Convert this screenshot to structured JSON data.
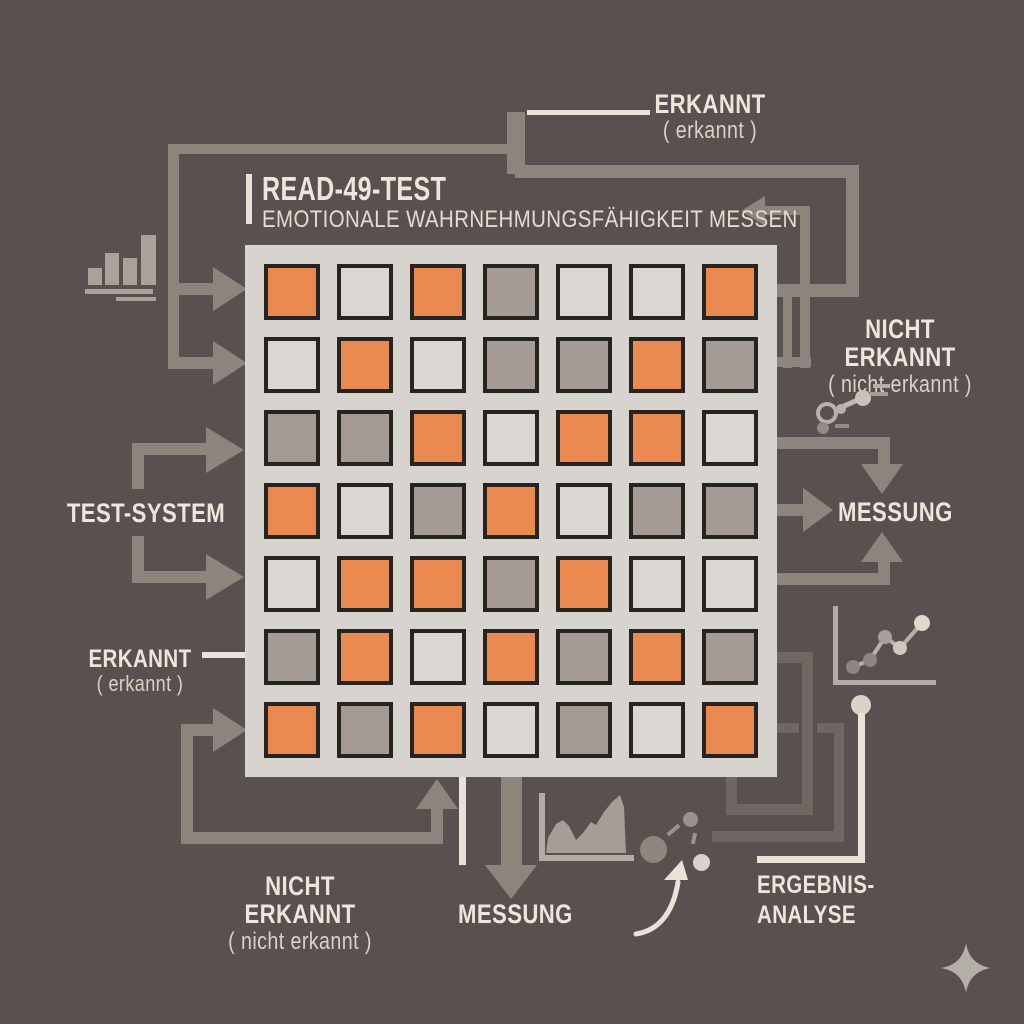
{
  "title": {
    "heading": "READ-49-TEST",
    "subtitle": "EMOTIONALE WAHRNEHMUNGSFÄHIGKEIT MESSEN"
  },
  "labels": {
    "top_erkannt": {
      "main": "ERKANNT",
      "sub": "( erkannt )"
    },
    "right_nicht_erkannt": {
      "main": "NICHT ERKANNT",
      "sub": "( nicht erkannt )"
    },
    "test_system": "TEST-SYSTEM",
    "right_messung": "MESSUNG",
    "left_erkannt": {
      "main": "ERKANNT",
      "sub": "( erkannt )"
    },
    "bottom_nicht_erkannt": {
      "main": "NICHT ERKANNT",
      "sub": "( nicht erkannt )"
    },
    "bottom_messung": "MESSUNG",
    "ergebnis_analyse": {
      "line1": "ERGEBNIS-",
      "line2": "ANALYSE"
    }
  },
  "grid": {
    "rows": 7,
    "cols": 7,
    "legend": {
      "O": "orange",
      "L": "light",
      "G": "gray"
    },
    "cells": [
      "OLOGLLO",
      "LOLGGOG",
      "GGOLOOL",
      "OLGOLGG",
      "LOOGOLL",
      "GOLOGOG",
      "OGOLGLO"
    ]
  },
  "colors": {
    "background": "#585150",
    "orange": "#ea8950",
    "cell_light": "#dad6d2",
    "cell_gray": "#a49b95",
    "grid_frame": "#d7d3ce",
    "cell_border": "#272320",
    "connector": "#8d847d",
    "connector_dark": "#6f6762",
    "cream": "#e9e3d7",
    "text": "#ece6dc",
    "text_dim": "#d9d2c5",
    "icon_light": "#b3aca5",
    "icon_mid": "#938b84"
  },
  "icons": {
    "top_left": "bar-chart-icon",
    "right_upper": "scatter-link-icon",
    "right_lower": "line-chart-icon",
    "bottom_middle": "area-chart-icon",
    "bottom_network": "molecule-icon",
    "bottom_right": "sparkle-icon"
  }
}
